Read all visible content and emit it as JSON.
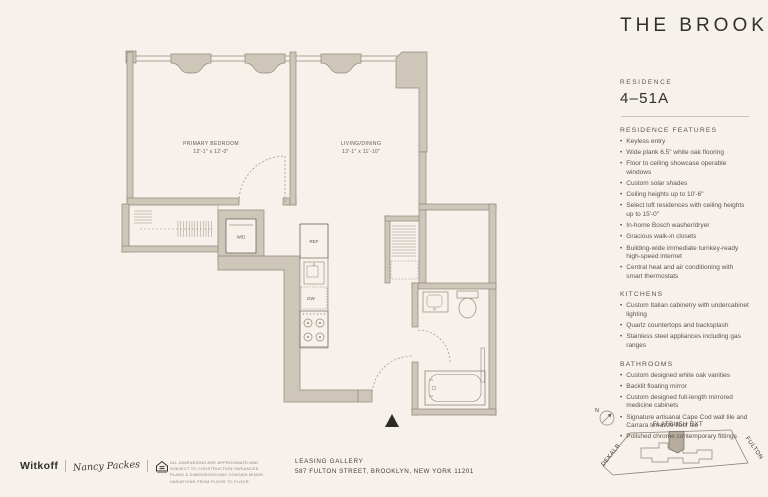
{
  "brand": {
    "title": "THE BROOK",
    "residence_label": "RESIDENCE",
    "residence_number": "4–51A"
  },
  "features": {
    "heading": "RESIDENCE FEATURES",
    "items": [
      "Keyless entry",
      "Wide plank 6.5\" white oak flooring",
      "Floor to ceiling showcase operable windows",
      "Custom solar shades",
      "Ceiling heights up to 10'-6\"",
      "Select loft residences with ceiling heights up to 15'-0\"",
      "In-home Bosch washer/dryer",
      "Gracious walk-in closets",
      "Building-wide immediate turnkey-ready high-speed internet",
      "Central heat and air conditioning with smart thermostats"
    ]
  },
  "kitchens": {
    "heading": "KITCHENS",
    "items": [
      "Custom Italian cabinetry with undercabinet lighting",
      "Quartz countertops and backsplash",
      "Stainless steel appliances including gas ranges"
    ]
  },
  "bathrooms": {
    "heading": "BATHROOMS",
    "items": [
      "Custom designed white oak vanities",
      "Backlit floating mirror",
      "Custom designed full-length mirrored medicine cabinets",
      "Signature artisanal Cape Cod wall tile and Carrara terrazzo floor tile",
      "Polished chrome contemporary fittings"
    ]
  },
  "floorplan": {
    "rooms": [
      {
        "name": "PRIMARY BEDROOM",
        "dims": "12'-1\" x 12'-0\""
      },
      {
        "name": "LIVING/DINING",
        "dims": "13'-1\" x 11'-10\""
      }
    ],
    "labels": {
      "washer_dryer": "W/D",
      "refrigerator": "REF",
      "dishwasher": "DW"
    }
  },
  "map": {
    "north_label": "N",
    "streets": [
      "FLATBUSH EXT",
      "DEKALB",
      "FULTON"
    ]
  },
  "footer": {
    "witkoff": "Witkoff",
    "signature": "Nancy Packes",
    "disclaimer": "ALL DIMENSIONS ARE APPROXIMATE AND SUBJECT TO CONSTRUCTION VARIANCES. PLANS & DIMENSIONS MAY CONTAIN MINOR VARIATIONS FROM FLOOR TO FLOOR.",
    "leasing_line1": "LEASING GALLERY",
    "leasing_line2": "587 FULTON STREET, BROOKLYN, NEW YORK 11201"
  },
  "colors": {
    "background": "#f6f1ea",
    "wall_fill": "#cec6b8",
    "line": "#8f887b",
    "ink": "#322e29",
    "muted_text": "#5b554d",
    "map_highlight": "#b5ac9e"
  }
}
